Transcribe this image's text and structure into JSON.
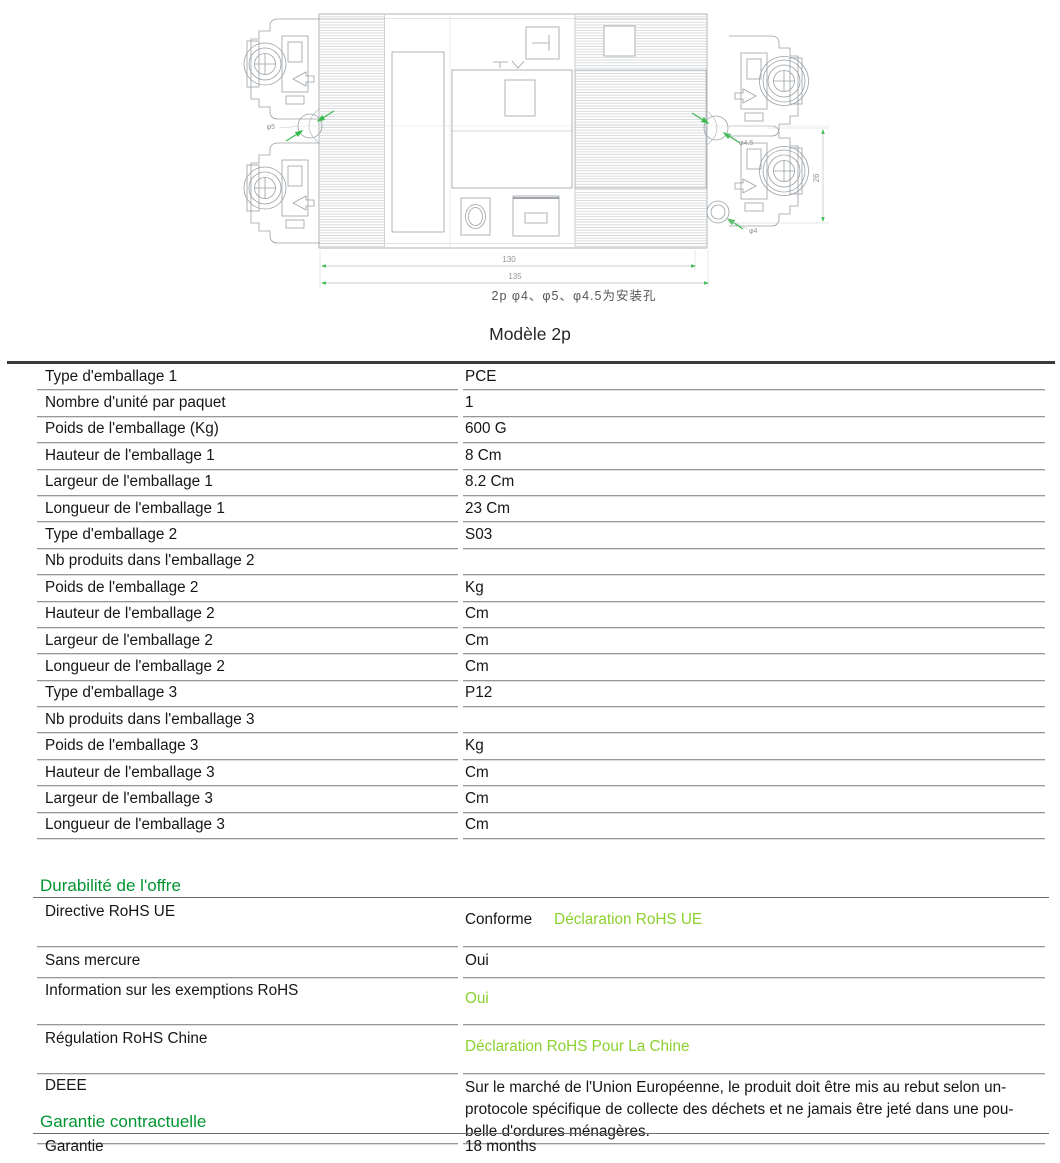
{
  "colors": {
    "section_green": "#009530",
    "link_green": "#8CD12F",
    "drawing_green": "#3CBB4E"
  },
  "drawing": {
    "caption": "2p  φ4、φ5、φ4.5为安装孔",
    "dims": {
      "width_inner": "130",
      "width_outer": "135",
      "height_right": "26"
    },
    "hole_labels": {
      "left": "φ5",
      "right": "φ4.5",
      "bottom": "φ4"
    }
  },
  "title": "Modèle 2p",
  "pkg": {
    "rows": [
      {
        "label": "Type d'emballage 1",
        "value": "PCE"
      },
      {
        "label": "Nombre d'unité par paquet",
        "value": "1"
      },
      {
        "label": "Poids de l'emballage (Kg)",
        "value": "600 G"
      },
      {
        "label": "Hauteur de l'emballage 1",
        "value": "8 Cm"
      },
      {
        "label": "Largeur de l'emballage 1",
        "value": "8.2 Cm"
      },
      {
        "label": "Longueur de l'emballage 1",
        "value": "23 Cm"
      },
      {
        "label": "Type d'emballage 2",
        "value": "S03"
      },
      {
        "label": "Nb produits dans l'emballage 2",
        "value": ""
      },
      {
        "label": "Poids de l'emballage 2",
        "value": "Kg"
      },
      {
        "label": "Hauteur de l'emballage 2",
        "value": "Cm"
      },
      {
        "label": "Largeur de l'emballage 2",
        "value": "Cm"
      },
      {
        "label": "Longueur de l'emballage 2",
        "value": "Cm"
      },
      {
        "label": "Type d'emballage 3",
        "value": "P12"
      },
      {
        "label": "Nb produits dans l'emballage 3",
        "value": ""
      },
      {
        "label": "Poids de l'emballage 3",
        "value": "Kg"
      },
      {
        "label": "Hauteur de l'emballage 3",
        "value": "Cm"
      },
      {
        "label": "Largeur de l'emballage 3",
        "value": "Cm"
      },
      {
        "label": "Longueur de l'emballage 3",
        "value": "Cm"
      }
    ]
  },
  "durability": {
    "heading": "Durabilité de l'offre",
    "rohs_eu": {
      "label": "Directive RoHS UE",
      "value": "Conforme",
      "link": "Déclaration RoHS UE"
    },
    "mercury": {
      "label": "Sans mercure",
      "value": "Oui"
    },
    "exemptions": {
      "label": "Information sur les exemptions RoHS",
      "link": "Oui"
    },
    "rohs_china": {
      "label": "Régulation RoHS Chine",
      "link": "Déclaration RoHS Pour La Chine"
    },
    "weee": {
      "label": "DEEE",
      "value_lines": [
        "Sur le marché de l'Union Européenne, le produit doit être mis au rebut selon un-",
        "protocole spécifique de collecte des déchets et ne jamais être jeté dans une pou-",
        "belle d'ordures ménagères."
      ]
    }
  },
  "warranty": {
    "heading": "Garantie contractuelle",
    "row": {
      "label": "Garantie",
      "value": "18 months"
    }
  }
}
